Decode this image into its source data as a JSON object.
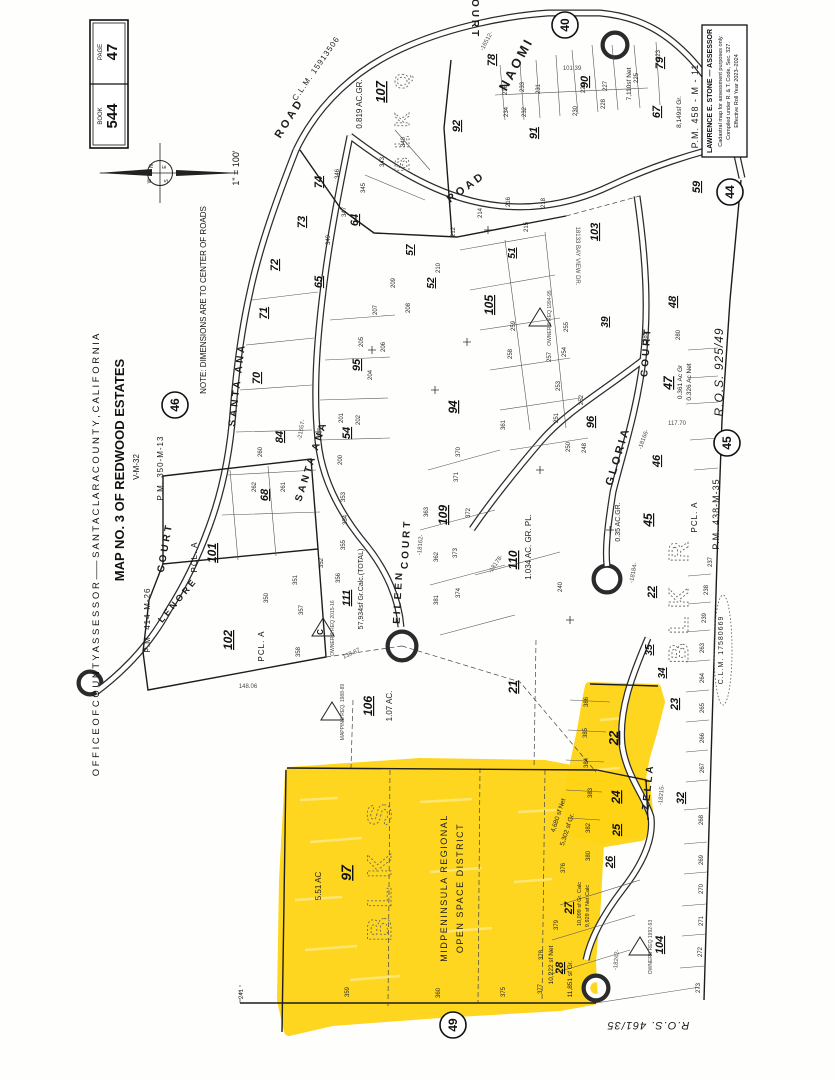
{
  "header": {
    "book_label": "BOOK",
    "book_value": "544",
    "page_label": "PAGE",
    "page_value": "47",
    "scale": "1\" = 100'"
  },
  "compass": {
    "n": "N",
    "e": "E",
    "s": "S",
    "w": "W"
  },
  "margin": {
    "office_line": "O F F I C E   O F   C O U N T Y   A S S E S S O R   ——   S A N T A   C L A R A   C O U N T Y ,   C A L I F O R N I A",
    "map_title": "MAP NO. 3 OF REDWOOD ESTATES",
    "map_subtitle": "V-M-32",
    "note": "NOTE: DIMENSIONS ARE TO CENTER OF ROADS"
  },
  "assessor_box": {
    "line1": "LAWRENCE E. STONE — ASSESSOR",
    "line2": "Cadastral map for assessment purposes only.",
    "line3": "Compiled under R. & T. Code, Sec. 327.",
    "line4": "Effective Roll Year 2023–2024"
  },
  "highlight": {
    "color": "#ffd414",
    "district_line1": "MIDPENINSULA REGIONAL",
    "district_line2": "OPEN SPACE DISTRICT",
    "block": "BLK S",
    "parcel": "97",
    "area": "5.51 AC"
  },
  "sheet_circles": [
    {
      "n": "40",
      "x": 565,
      "y": 25
    },
    {
      "n": "44",
      "x": 730,
      "y": 192
    },
    {
      "n": "45",
      "x": 727,
      "y": 443
    },
    {
      "n": "46",
      "x": 175,
      "y": 405
    },
    {
      "n": "49",
      "x": 453,
      "y": 1025
    }
  ],
  "triangles": [
    {
      "x": 323,
      "y": 628,
      "l": "C"
    },
    {
      "x": 332,
      "y": 712,
      "l": ""
    },
    {
      "x": 540,
      "y": 318,
      "l": ""
    },
    {
      "x": 640,
      "y": 947,
      "l": ""
    }
  ],
  "map_labels": [
    [
      "SANTA ANA",
      240,
      385,
      -83,
      10,
      "st"
    ],
    [
      "SANTA ANA",
      314,
      462,
      -72,
      10,
      "st"
    ],
    [
      "ROAD",
      292,
      120,
      -58,
      11,
      "st"
    ],
    [
      "ROAD",
      468,
      190,
      -36,
      11,
      "st"
    ],
    [
      "NAOMI",
      520,
      66,
      -62,
      13,
      "st"
    ],
    [
      "COURT",
      472,
      14,
      90,
      10,
      "st"
    ],
    [
      "COURT",
      168,
      548,
      -80,
      10,
      "st"
    ],
    [
      "LENORE",
      180,
      602,
      -50,
      9,
      "st"
    ],
    [
      "EILEEN",
      401,
      597,
      -87,
      10,
      "st"
    ],
    [
      "COURT",
      409,
      544,
      -87,
      10,
      "st"
    ],
    [
      "GLORIA",
      621,
      457,
      -73,
      11,
      "st"
    ],
    [
      "COURT",
      649,
      352,
      -86,
      10,
      "st"
    ],
    [
      "ZELLA",
      651,
      787,
      -84,
      10,
      "st"
    ],
    [
      "18133 BAY VIEW DR.",
      576,
      256,
      90,
      6,
      "dm"
    ],
    [
      "C.L.M. 15913506",
      318,
      70,
      -55,
      8,
      "rf"
    ],
    [
      "C.L.M. 17580669",
      723,
      650,
      -90,
      7,
      "rf"
    ],
    [
      "P.M. 350-M-13",
      163,
      468,
      -90,
      8,
      "rf"
    ],
    [
      "P.M. 414-M-26",
      150,
      620,
      -90,
      8,
      "rf"
    ],
    [
      "P.M. 438-M-35",
      719,
      514,
      -90,
      9,
      "rf"
    ],
    [
      "P.M. 458 - M - 11",
      698,
      106,
      -90,
      9,
      "rf"
    ],
    [
      "R.O.S.  925/49",
      723,
      372,
      -90,
      12,
      "ri"
    ],
    [
      "R.O.S.  461/35",
      648,
      1022,
      180,
      11,
      "ri"
    ],
    [
      "0.819 AC.GR.",
      362,
      104,
      -90,
      8,
      "ar"
    ],
    [
      "1.034 AC. GR. PL.",
      531,
      547,
      -90,
      8,
      "ar"
    ],
    [
      "0.35 AC.GR.",
      620,
      522,
      -90,
      7,
      "ar"
    ],
    [
      "0.361 Ac Gr",
      682,
      382,
      -90,
      6.5,
      "ar"
    ],
    [
      "0.326 Ac Net",
      691,
      382,
      -90,
      6.5,
      "ar"
    ],
    [
      "1.07 AC.",
      392,
      706,
      -90,
      8,
      "ar"
    ],
    [
      "5.51 AC",
      321,
      886,
      -90,
      8,
      "ar"
    ],
    [
      "57,934sf Gr.Calc.(TOTAL)",
      363,
      589,
      -90,
      7,
      "ar"
    ],
    [
      "7,110sf Net",
      631,
      84,
      -90,
      6.5,
      "ar"
    ],
    [
      "8,149sf Gr.",
      681,
      112,
      -90,
      6.5,
      "ar"
    ],
    [
      "4,680 sf Net",
      560,
      816,
      -72,
      6.5,
      "ar"
    ],
    [
      "5,302 sf Gr.",
      569,
      830,
      -72,
      6.5,
      "ar"
    ],
    [
      "10,222 sf Net",
      553,
      965,
      -90,
      6.5,
      "ar"
    ],
    [
      "11,851 sf Gr.",
      572,
      979,
      -90,
      6.5,
      "ar"
    ],
    [
      "10,099 sf Gr. Calc",
      581,
      904,
      -90,
      5.5,
      "ar"
    ],
    [
      "9,929 sf Net Calc",
      589,
      906,
      -90,
      5.5,
      "ar"
    ],
    [
      "BLK S",
      391,
      868,
      -90,
      34,
      "bk"
    ],
    [
      "BLK R",
      688,
      598,
      -90,
      28,
      "bk"
    ],
    [
      "BLK Q",
      409,
      118,
      -90,
      20,
      "bk"
    ],
    [
      "MIDPENINSULA REGIONAL",
      447,
      888,
      -90,
      9,
      "ds"
    ],
    [
      "OPEN SPACE DISTRICT",
      463,
      888,
      -90,
      9,
      "ds"
    ],
    [
      "PCL. A",
      197,
      557,
      -90,
      8,
      "pc"
    ],
    [
      "PCL. A",
      264,
      646,
      -90,
      8,
      "pc"
    ],
    [
      "PCL. A",
      697,
      517,
      -90,
      8,
      "pc"
    ],
    [
      "107",
      385,
      92,
      -90,
      13,
      "pr"
    ],
    [
      "92",
      460,
      126,
      -90,
      11,
      "pr"
    ],
    [
      "91",
      537,
      133,
      -90,
      11,
      "pr"
    ],
    [
      "90",
      588,
      82,
      -90,
      11,
      "pr"
    ],
    [
      "78",
      495,
      60,
      -90,
      11,
      "pr"
    ],
    [
      "79",
      663,
      63,
      -90,
      11,
      "pr"
    ],
    [
      "67",
      660,
      112,
      -90,
      11,
      "pr"
    ],
    [
      "59",
      700,
      187,
      -90,
      11,
      "pr"
    ],
    [
      "103",
      598,
      232,
      -90,
      11,
      "pr"
    ],
    [
      "105",
      493,
      305,
      -90,
      12,
      "pr"
    ],
    [
      "94",
      457,
      407,
      -90,
      12,
      "pr"
    ],
    [
      "96",
      594,
      422,
      -90,
      11,
      "pr"
    ],
    [
      "95",
      360,
      365,
      -90,
      11,
      "pr"
    ],
    [
      "57",
      413,
      250,
      -90,
      10,
      "pr"
    ],
    [
      "52",
      434,
      283,
      -90,
      10,
      "pr"
    ],
    [
      "51",
      515,
      253,
      -90,
      10,
      "pr"
    ],
    [
      "64",
      358,
      220,
      -90,
      11,
      "pr"
    ],
    [
      "65",
      322,
      282,
      -90,
      11,
      "pr"
    ],
    [
      "68",
      268,
      495,
      -90,
      11,
      "pr"
    ],
    [
      "70",
      260,
      378,
      -90,
      11,
      "pr"
    ],
    [
      "71",
      267,
      313,
      -90,
      11,
      "pr"
    ],
    [
      "72",
      278,
      265,
      -90,
      11,
      "pr"
    ],
    [
      "73",
      305,
      222,
      -90,
      11,
      "pr"
    ],
    [
      "74",
      322,
      182,
      -90,
      11,
      "pr"
    ],
    [
      "84",
      283,
      437,
      -90,
      11,
      "pr"
    ],
    [
      "54",
      350,
      433,
      -90,
      11,
      "pr"
    ],
    [
      "101",
      216,
      553,
      -90,
      12,
      "pr"
    ],
    [
      "102",
      232,
      640,
      -90,
      12,
      "pr"
    ],
    [
      "106",
      372,
      706,
      -90,
      12,
      "pr"
    ],
    [
      "109",
      447,
      515,
      -90,
      12,
      "pr"
    ],
    [
      "110",
      517,
      560,
      -90,
      12,
      "pr"
    ],
    [
      "111",
      350,
      598,
      -90,
      11,
      "pr"
    ],
    [
      "45",
      652,
      520,
      -90,
      12,
      "pr"
    ],
    [
      "46",
      660,
      461,
      -90,
      11,
      "pr"
    ],
    [
      "47",
      672,
      383,
      -90,
      12,
      "pr"
    ],
    [
      "48",
      676,
      302,
      -90,
      11,
      "pr"
    ],
    [
      "21",
      517,
      687,
      -90,
      12,
      "pr"
    ],
    [
      "22",
      655,
      592,
      -90,
      11,
      "pr"
    ],
    [
      "22",
      618,
      738,
      -90,
      13,
      "pr"
    ],
    [
      "24",
      620,
      797,
      -90,
      12,
      "pr"
    ],
    [
      "23",
      678,
      704,
      -90,
      11,
      "pr"
    ],
    [
      "25",
      620,
      830,
      -90,
      11,
      "pr"
    ],
    [
      "26",
      613,
      862,
      -90,
      11,
      "pr"
    ],
    [
      "27",
      572,
      908,
      -90,
      11,
      "pr"
    ],
    [
      "28",
      563,
      968,
      -90,
      11,
      "pr"
    ],
    [
      "32",
      684,
      798,
      -90,
      11,
      "pr"
    ],
    [
      "34",
      665,
      673,
      -90,
      10,
      "pr"
    ],
    [
      "35",
      652,
      650,
      -90,
      10,
      "pr"
    ],
    [
      "97",
      351,
      873,
      -90,
      14,
      "pr"
    ],
    [
      "104",
      663,
      945,
      -90,
      11,
      "pr"
    ],
    [
      "39",
      608,
      322,
      -90,
      10,
      "pr"
    ],
    [
      "236",
      507,
      90,
      -90,
      6,
      "lt"
    ],
    [
      "234",
      508,
      112,
      -90,
      6,
      "lt"
    ],
    [
      "233",
      524,
      87,
      -90,
      6,
      "lt"
    ],
    [
      "232",
      526,
      112,
      -90,
      6,
      "lt"
    ],
    [
      "231",
      540,
      89,
      -90,
      6,
      "lt"
    ],
    [
      "230",
      577,
      111,
      -90,
      6,
      "lt"
    ],
    [
      "229",
      585,
      88,
      -90,
      6,
      "lt"
    ],
    [
      "228",
      605,
      104,
      -90,
      6,
      "lt"
    ],
    [
      "227",
      607,
      86,
      -90,
      6,
      "lt"
    ],
    [
      "225",
      638,
      78,
      -90,
      6,
      "lt"
    ],
    [
      "223",
      660,
      55,
      -90,
      6,
      "lt"
    ],
    [
      "343",
      384,
      162,
      -90,
      6,
      "lt"
    ],
    [
      "345",
      365,
      188,
      -90,
      6,
      "lt"
    ],
    [
      "346",
      339,
      174,
      -90,
      6,
      "lt"
    ],
    [
      "347",
      346,
      212,
      -90,
      6,
      "lt"
    ],
    [
      "349",
      330,
      240,
      -90,
      6,
      "lt"
    ],
    [
      "340",
      405,
      142,
      -90,
      6,
      "lt"
    ],
    [
      "209",
      395,
      283,
      -90,
      6,
      "lt"
    ],
    [
      "208",
      410,
      308,
      -90,
      6,
      "lt"
    ],
    [
      "207",
      377,
      310,
      -90,
      6,
      "lt"
    ],
    [
      "206",
      385,
      347,
      -90,
      6,
      "lt"
    ],
    [
      "205",
      363,
      342,
      -90,
      6,
      "lt"
    ],
    [
      "204",
      372,
      375,
      -90,
      6,
      "lt"
    ],
    [
      "202",
      360,
      420,
      -90,
      6,
      "lt"
    ],
    [
      "201",
      343,
      418,
      -90,
      6,
      "lt"
    ],
    [
      "200",
      342,
      460,
      -90,
      6,
      "lt"
    ],
    [
      "259",
      515,
      326,
      -90,
      6,
      "lt"
    ],
    [
      "258",
      512,
      354,
      -90,
      6,
      "lt"
    ],
    [
      "257",
      551,
      357,
      -90,
      6,
      "lt"
    ],
    [
      "255",
      568,
      327,
      -90,
      6,
      "lt"
    ],
    [
      "254",
      566,
      352,
      -90,
      6,
      "lt"
    ],
    [
      "253",
      560,
      386,
      -90,
      6,
      "lt"
    ],
    [
      "252",
      583,
      400,
      -90,
      6,
      "lt"
    ],
    [
      "251",
      558,
      418,
      -90,
      6,
      "lt"
    ],
    [
      "250",
      570,
      447,
      -90,
      6,
      "lt"
    ],
    [
      "248",
      586,
      448,
      -90,
      6,
      "lt"
    ],
    [
      "260",
      262,
      452,
      -90,
      6,
      "lt"
    ],
    [
      "261",
      285,
      487,
      -90,
      6,
      "lt"
    ],
    [
      "262",
      256,
      487,
      -90,
      6,
      "lt"
    ],
    [
      "350",
      268,
      598,
      -90,
      6,
      "lt"
    ],
    [
      "351",
      297,
      580,
      -90,
      6,
      "lt"
    ],
    [
      "352",
      323,
      563,
      -90,
      6,
      "lt"
    ],
    [
      "353",
      345,
      497,
      -90,
      6,
      "lt"
    ],
    [
      "354",
      347,
      520,
      -90,
      6,
      "lt"
    ],
    [
      "355",
      345,
      545,
      -90,
      6,
      "lt"
    ],
    [
      "356",
      340,
      578,
      -90,
      6,
      "lt"
    ],
    [
      "357",
      303,
      610,
      -90,
      6,
      "lt"
    ],
    [
      "358",
      300,
      652,
      -90,
      6,
      "lt"
    ],
    [
      "362",
      438,
      557,
      -90,
      6,
      "lt"
    ],
    [
      "363",
      428,
      512,
      -90,
      6,
      "lt"
    ],
    [
      "372",
      470,
      513,
      -90,
      6,
      "lt"
    ],
    [
      "373",
      457,
      553,
      -90,
      6,
      "lt"
    ],
    [
      "374",
      460,
      593,
      -90,
      6,
      "lt"
    ],
    [
      "381",
      438,
      600,
      -90,
      6,
      "lt"
    ],
    [
      "370",
      460,
      452,
      -90,
      6,
      "lt"
    ],
    [
      "371",
      458,
      477,
      -90,
      6,
      "lt"
    ],
    [
      "361",
      505,
      425,
      -90,
      6,
      "lt"
    ],
    [
      "240",
      562,
      587,
      -90,
      6,
      "lt"
    ],
    [
      "237",
      712,
      562,
      -90,
      6,
      "lt"
    ],
    [
      "238",
      708,
      590,
      -90,
      6,
      "lt"
    ],
    [
      "239",
      706,
      618,
      -90,
      6,
      "lt"
    ],
    [
      "263",
      704,
      648,
      -90,
      6,
      "lt"
    ],
    [
      "264",
      704,
      678,
      -90,
      6,
      "lt"
    ],
    [
      "265",
      704,
      708,
      -90,
      6,
      "lt"
    ],
    [
      "266",
      704,
      738,
      -90,
      6,
      "lt"
    ],
    [
      "267",
      704,
      768,
      -90,
      6,
      "lt"
    ],
    [
      "268",
      703,
      820,
      -90,
      6,
      "lt"
    ],
    [
      "269",
      703,
      860,
      -90,
      6,
      "lt"
    ],
    [
      "270",
      703,
      889,
      -90,
      6,
      "lt"
    ],
    [
      "271",
      703,
      921,
      -90,
      6,
      "lt"
    ],
    [
      "272",
      702,
      952,
      -90,
      6,
      "lt"
    ],
    [
      "273",
      700,
      988,
      -90,
      6,
      "lt"
    ],
    [
      "359",
      349,
      992,
      -90,
      6,
      "lt"
    ],
    [
      "360",
      440,
      993,
      -90,
      6,
      "lt"
    ],
    [
      "375",
      505,
      992,
      -90,
      6,
      "lt"
    ],
    [
      "241",
      243,
      994,
      -90,
      6,
      "lt"
    ],
    [
      "377",
      542,
      989,
      -90,
      6,
      "lt"
    ],
    [
      "378",
      543,
      955,
      -90,
      6,
      "lt"
    ],
    [
      "379",
      558,
      925,
      -90,
      6,
      "lt"
    ],
    [
      "376",
      565,
      868,
      -90,
      6,
      "lt"
    ],
    [
      "383",
      592,
      793,
      -90,
      6,
      "lt"
    ],
    [
      "384",
      588,
      763,
      -90,
      6,
      "lt"
    ],
    [
      "385",
      587,
      733,
      -90,
      6,
      "lt"
    ],
    [
      "386",
      588,
      702,
      -90,
      6,
      "lt"
    ],
    [
      "382",
      590,
      828,
      -90,
      6,
      "lt"
    ],
    [
      "380",
      590,
      856,
      -90,
      6,
      "lt"
    ],
    [
      "218",
      545,
      203,
      -90,
      6,
      "lt"
    ],
    [
      "216",
      510,
      202,
      -90,
      6,
      "lt"
    ],
    [
      "215",
      528,
      227,
      -90,
      6,
      "lt"
    ],
    [
      "214",
      482,
      213,
      -90,
      6,
      "lt"
    ],
    [
      "212",
      455,
      232,
      -90,
      6,
      "lt"
    ],
    [
      "210",
      440,
      268,
      -90,
      6,
      "lt"
    ],
    [
      "281",
      647,
      337,
      -90,
      6,
      "lt"
    ],
    [
      "280",
      680,
      335,
      -90,
      6,
      "lt"
    ],
    [
      "148.06",
      248,
      688,
      0,
      6,
      "dm"
    ],
    [
      "138.87",
      352,
      655,
      -25,
      6,
      "dm"
    ],
    [
      "117.70",
      677,
      425,
      0,
      6,
      "dm"
    ],
    [
      "101.39",
      572,
      70,
      0,
      6,
      "dm"
    ],
    [
      "-16512-",
      488,
      42,
      -62,
      6,
      "dm"
    ],
    [
      "-21557-",
      303,
      430,
      -80,
      6,
      "dm"
    ],
    [
      "-18162-",
      422,
      545,
      -85,
      6,
      "dm"
    ],
    [
      "-18178-",
      497,
      565,
      -55,
      6,
      "dm"
    ],
    [
      "-18184-",
      635,
      573,
      -80,
      6,
      "dm"
    ],
    [
      "-18215-",
      663,
      795,
      -85,
      6,
      "dm"
    ],
    [
      "-18242-",
      618,
      960,
      -85,
      6,
      "dm"
    ],
    [
      "-18166-",
      645,
      440,
      -70,
      6,
      "dm"
    ],
    [
      "MAPPING REQ. 1988-89",
      344,
      712,
      -90,
      5,
      "dm"
    ],
    [
      "OWNER'S REQ 1994-95",
      551,
      318,
      -90,
      5,
      "dm"
    ],
    [
      "OWNERS REQ 1992-93",
      652,
      947,
      -90,
      5,
      "dm"
    ],
    [
      "OWNER'S REQ 2015-16",
      334,
      628,
      -90,
      5,
      "dm"
    ]
  ]
}
